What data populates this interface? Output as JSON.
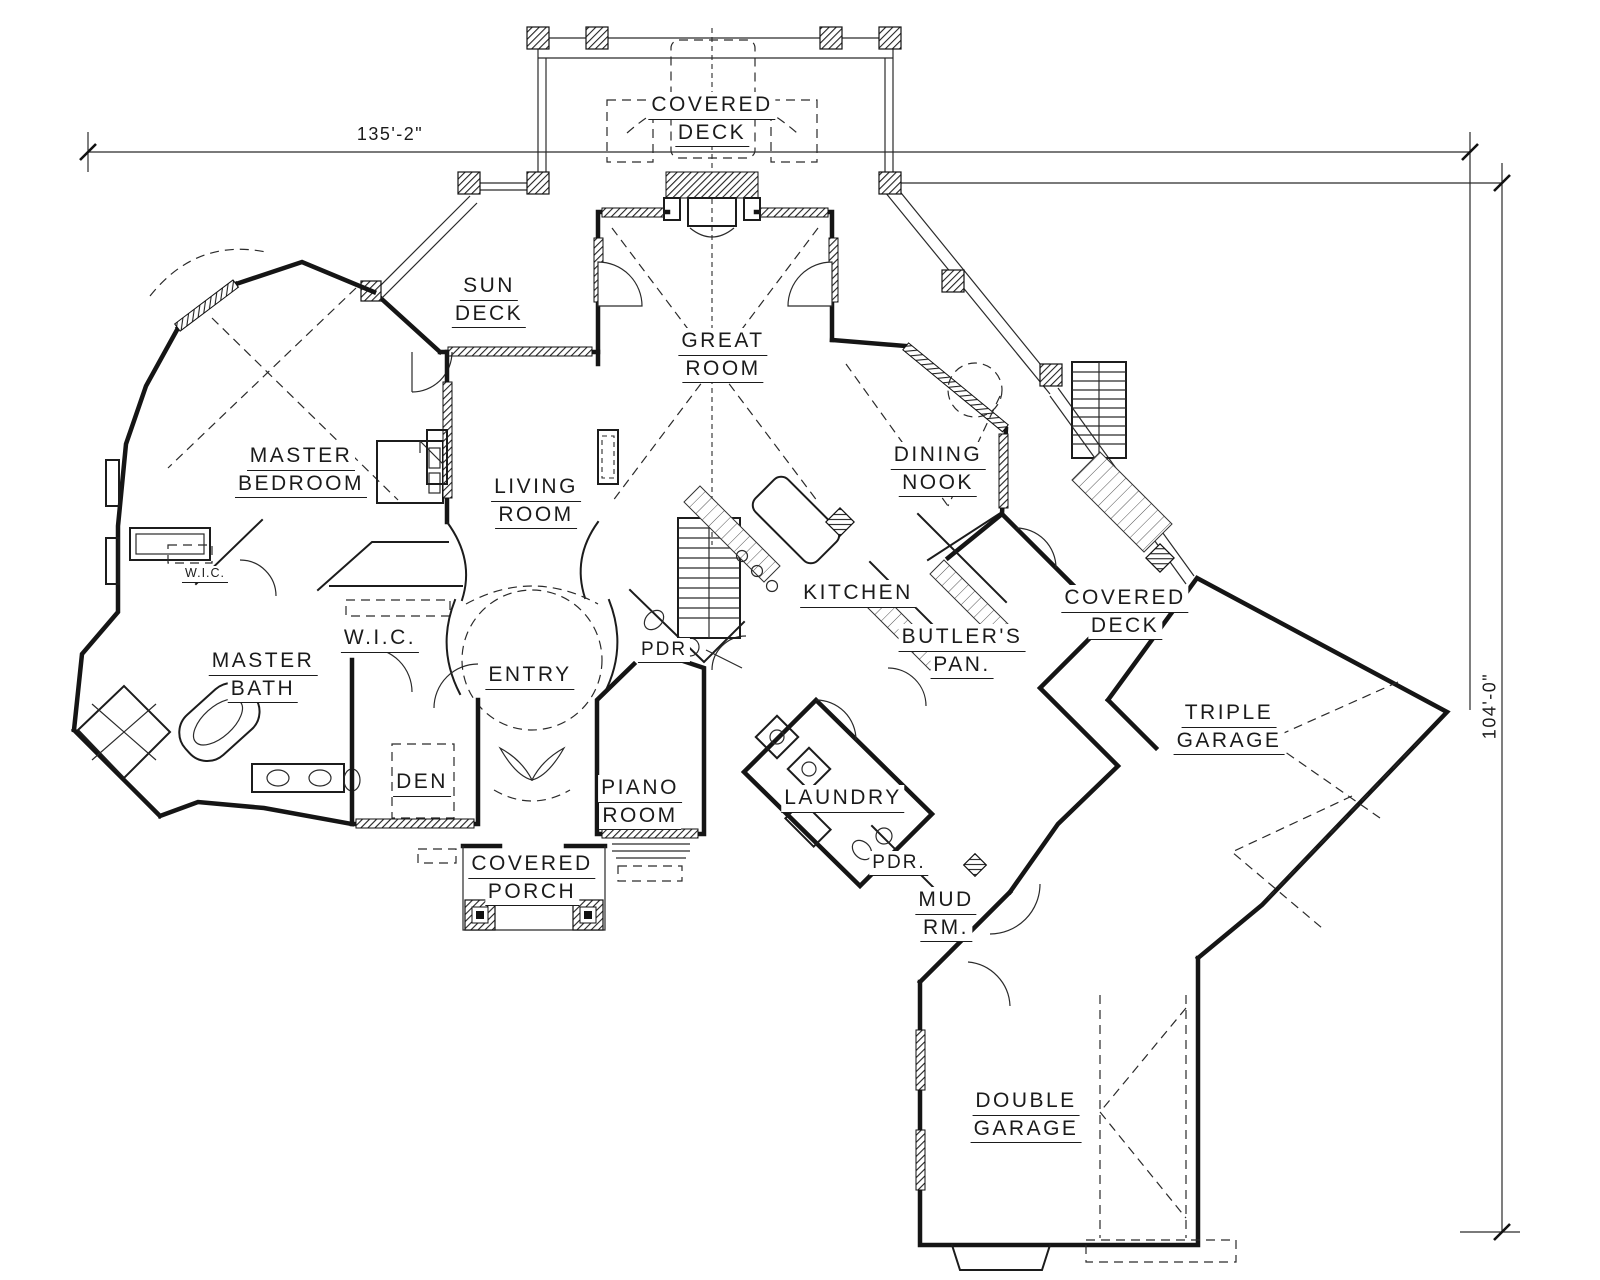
{
  "drawing": {
    "dimension_top": "135'-2\"",
    "dimension_right": "104'-0\"",
    "rooms": {
      "covered_deck_top": {
        "l1": "COVERED",
        "l2": "DECK"
      },
      "sun_deck": {
        "l1": "SUN",
        "l2": "DECK"
      },
      "great_room": {
        "l1": "GREAT",
        "l2": "ROOM"
      },
      "master_bedroom": {
        "l1": "MASTER",
        "l2": "BEDROOM"
      },
      "living_room": {
        "l1": "LIVING",
        "l2": "ROOM"
      },
      "dining_nook": {
        "l1": "DINING",
        "l2": "NOOK"
      },
      "wic_small": {
        "l1": "W.I.C."
      },
      "wic_large": {
        "l1": "W.I.C."
      },
      "master_bath": {
        "l1": "MASTER",
        "l2": "BATH"
      },
      "entry": {
        "l1": "ENTRY"
      },
      "pdr_entry": {
        "l1": "PDR"
      },
      "kitchen": {
        "l1": "KITCHEN"
      },
      "butlers_pantry": {
        "l1": "BUTLER'S",
        "l2": "PAN."
      },
      "covered_deck_right": {
        "l1": "COVERED",
        "l2": "DECK"
      },
      "triple_garage": {
        "l1": "TRIPLE",
        "l2": "GARAGE"
      },
      "den": {
        "l1": "DEN"
      },
      "piano_room": {
        "l1": "PIANO",
        "l2": "ROOM"
      },
      "laundry": {
        "l1": "LAUNDRY"
      },
      "covered_porch": {
        "l1": "COVERED",
        "l2": "PORCH"
      },
      "pdr_mud": {
        "l1": "PDR."
      },
      "mud_room": {
        "l1": "MUD",
        "l2": "RM."
      },
      "double_garage": {
        "l1": "DOUBLE",
        "l2": "GARAGE"
      }
    }
  }
}
